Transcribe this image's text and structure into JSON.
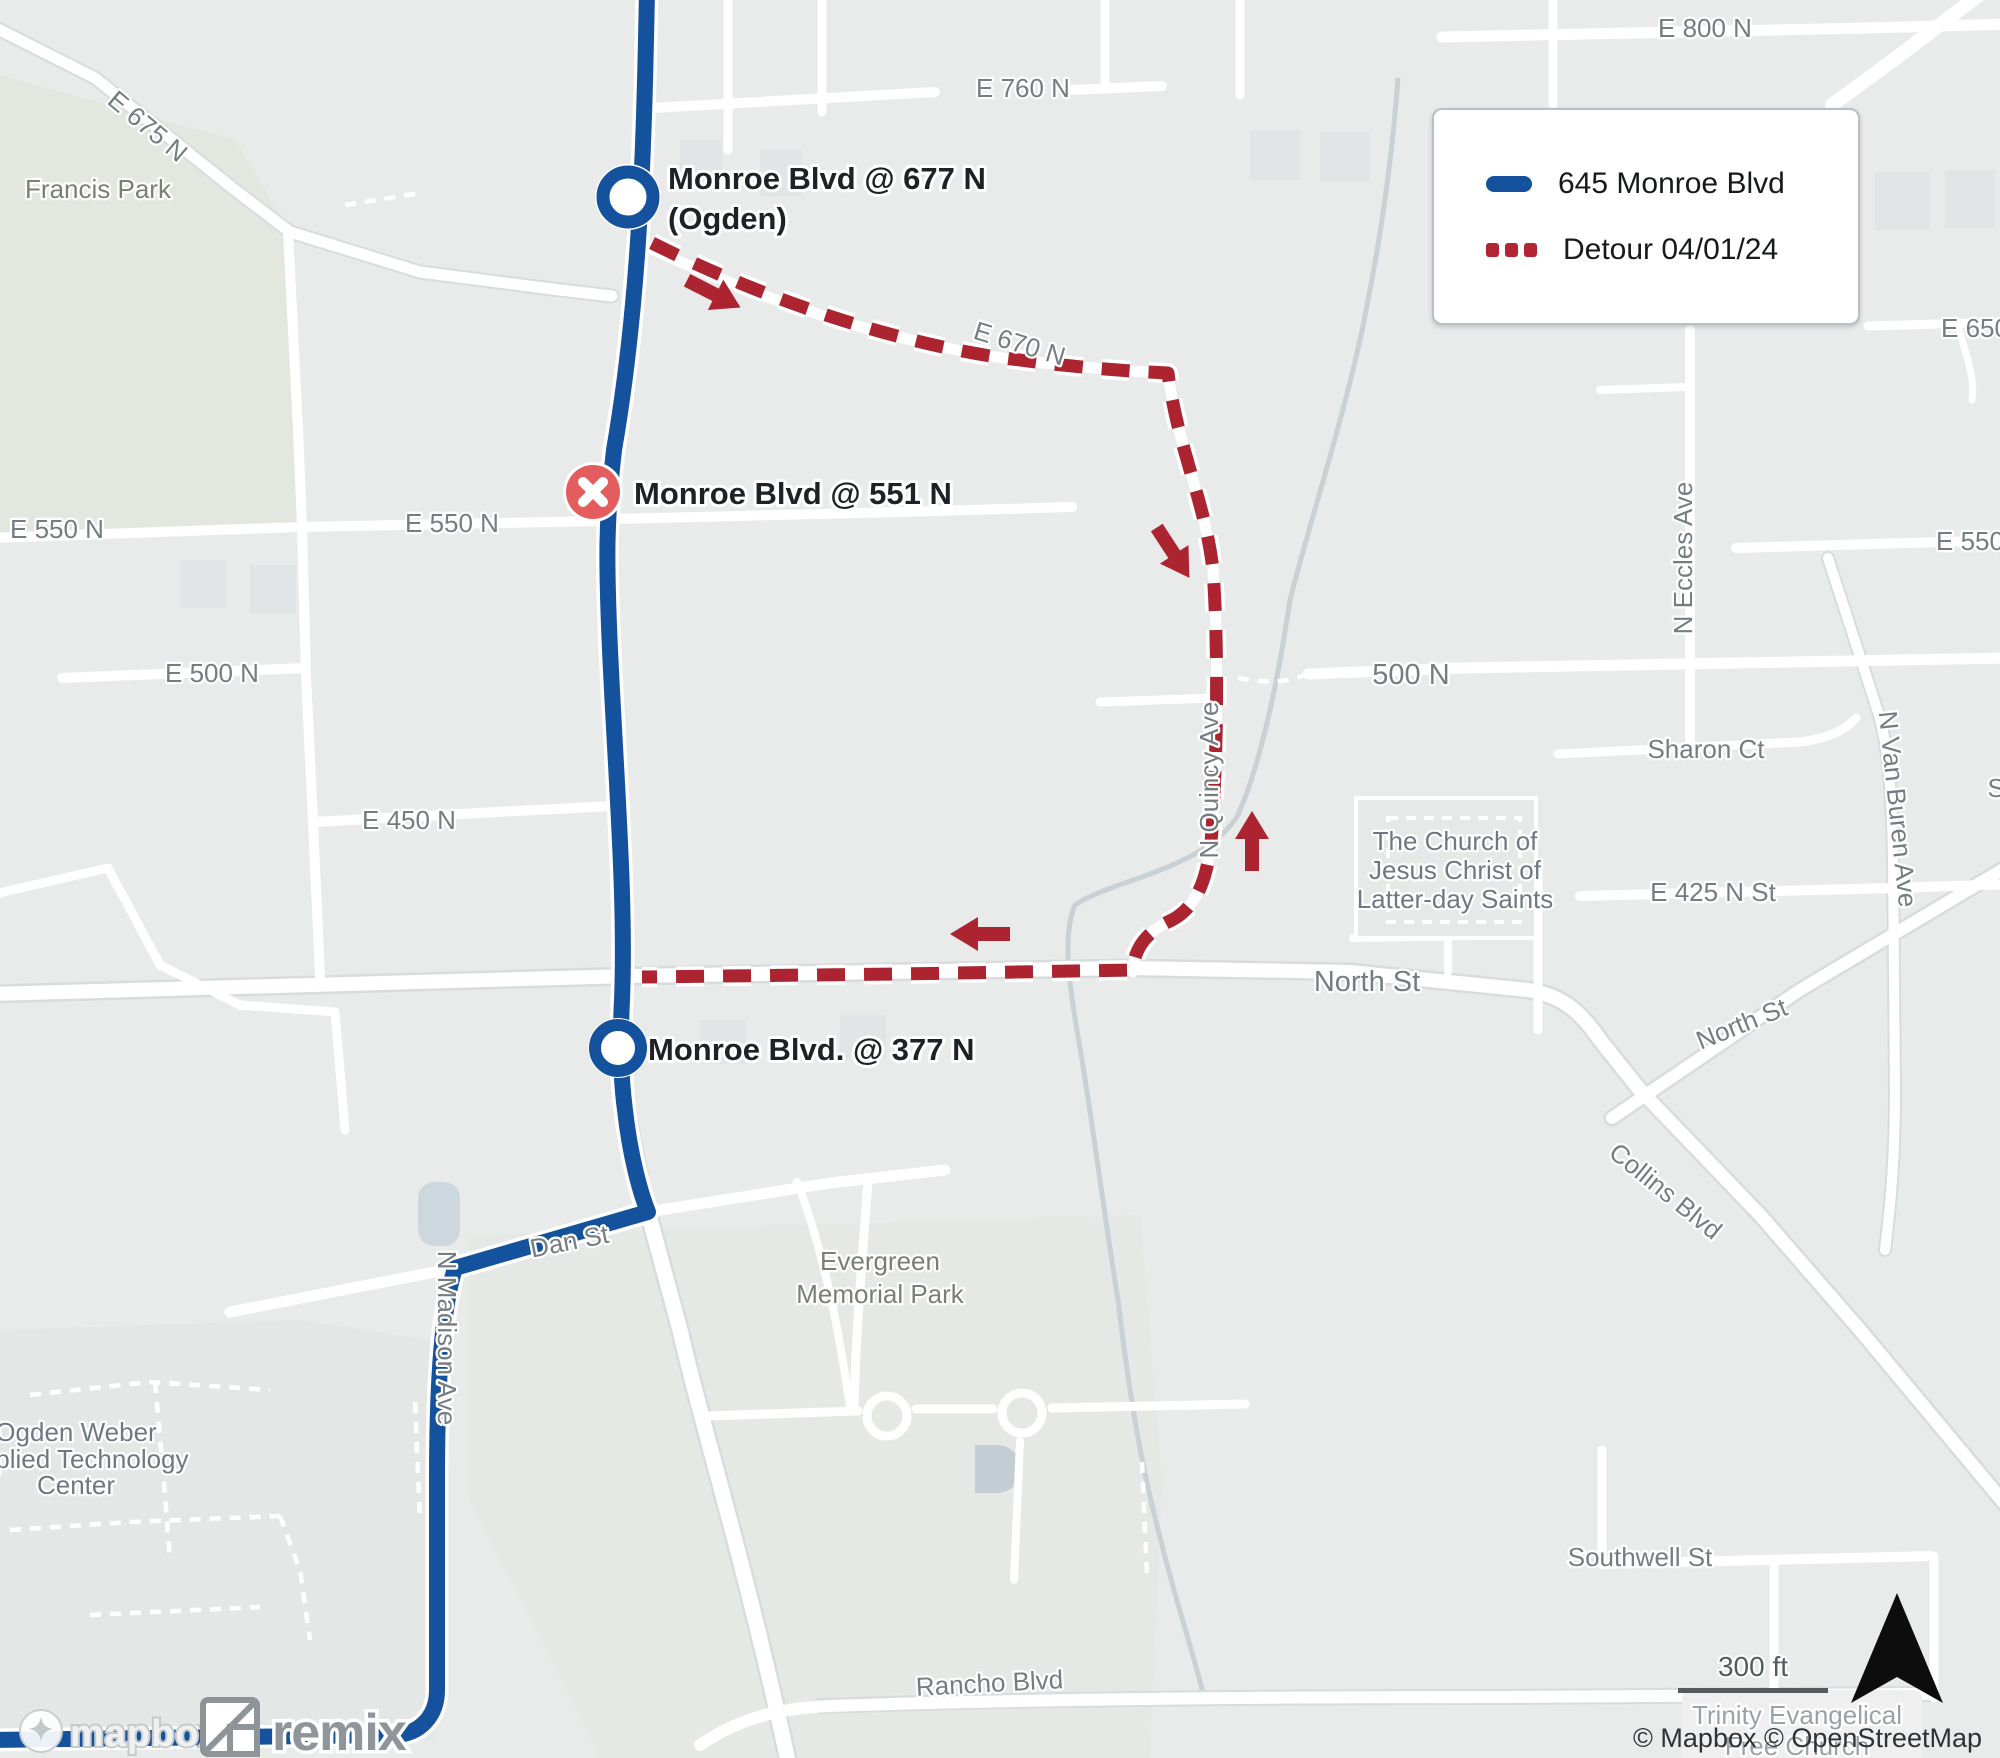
{
  "legend": {
    "route_label": "645 Monroe Blvd",
    "detour_label": "Detour 04/01/24",
    "route_color": "#15529e",
    "detour_color": "#b22633"
  },
  "stops": {
    "stop_677_line1": "Monroe Blvd @ 677 N",
    "stop_677_line2": "(Ogden)",
    "stop_551": "Monroe Blvd @ 551 N",
    "stop_377": "Monroe Blvd. @ 377 N"
  },
  "streets": {
    "e675n": "E 675 N",
    "francis_park": "Francis Park",
    "e760n": "E 760 N",
    "e800n": "E 800 N",
    "e650": "E 650",
    "e670n": "E 670 N",
    "e550n_left": "E 550 N",
    "e550n_mid": "E 550 N",
    "e550_right": "E 550",
    "e500n": "E 500 N",
    "n500": "500 N",
    "e450n": "E 450 N",
    "sharon_ct": "Sharon Ct",
    "e425n_st": "E 425 N St",
    "n_eccles_ave": "N Eccles Ave",
    "n_van_buren_ave": "N Van Buren Ave",
    "n_quincy_ave": "N Quincy Ave",
    "north_st": "North St",
    "north_st_diag": "North St",
    "collins_blvd": "Collins Blvd",
    "evergreen_line1": "Evergreen",
    "evergreen_line2": "Memorial Park",
    "dan_st": "Dan St",
    "n_madison_ave": "N Madison Ave",
    "ogden_line1": "Ogden Weber",
    "ogden_line2": "Applied Technology",
    "ogden_line3": "Center",
    "southwell_st": "Southwell St",
    "rancho_blvd": "Rancho Blvd",
    "trinity_line1": "Trinity Evangelical",
    "trinity_line2": "Free Church",
    "church_line1": "The Church of",
    "church_line2": "Jesus Christ of",
    "church_line3": "Latter-day Saints",
    "s_partial": "S"
  },
  "scale": {
    "label": "300 ft"
  },
  "attribution": {
    "text": "© Mapbox © OpenStreetMap"
  },
  "logos": {
    "mapbox": "mapbox",
    "remix": "remix"
  }
}
